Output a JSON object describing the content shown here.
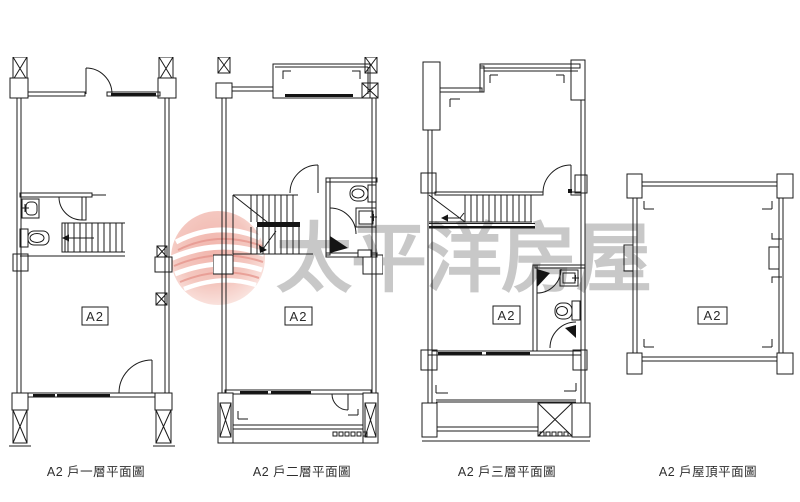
{
  "page": {
    "background": "#ffffff",
    "line_color": "#1b1b1b"
  },
  "watermark": {
    "text": "太平洋房屋",
    "logo_name": "pacific-house-globe-logo",
    "text_color": "#a8a8a8",
    "logo_pink": "#f0b0a7"
  },
  "plans": [
    {
      "id": "first-floor",
      "unit_label": "A2",
      "caption": "A2 戶一層平面圖"
    },
    {
      "id": "second-floor",
      "unit_label": "A2",
      "caption": "A2 戶二層平面圖"
    },
    {
      "id": "third-floor",
      "unit_label": "A2",
      "caption": "A2 戶三層平面圖"
    },
    {
      "id": "roof",
      "unit_label": "A2",
      "caption": "A2 戶屋頂平面圖"
    }
  ]
}
